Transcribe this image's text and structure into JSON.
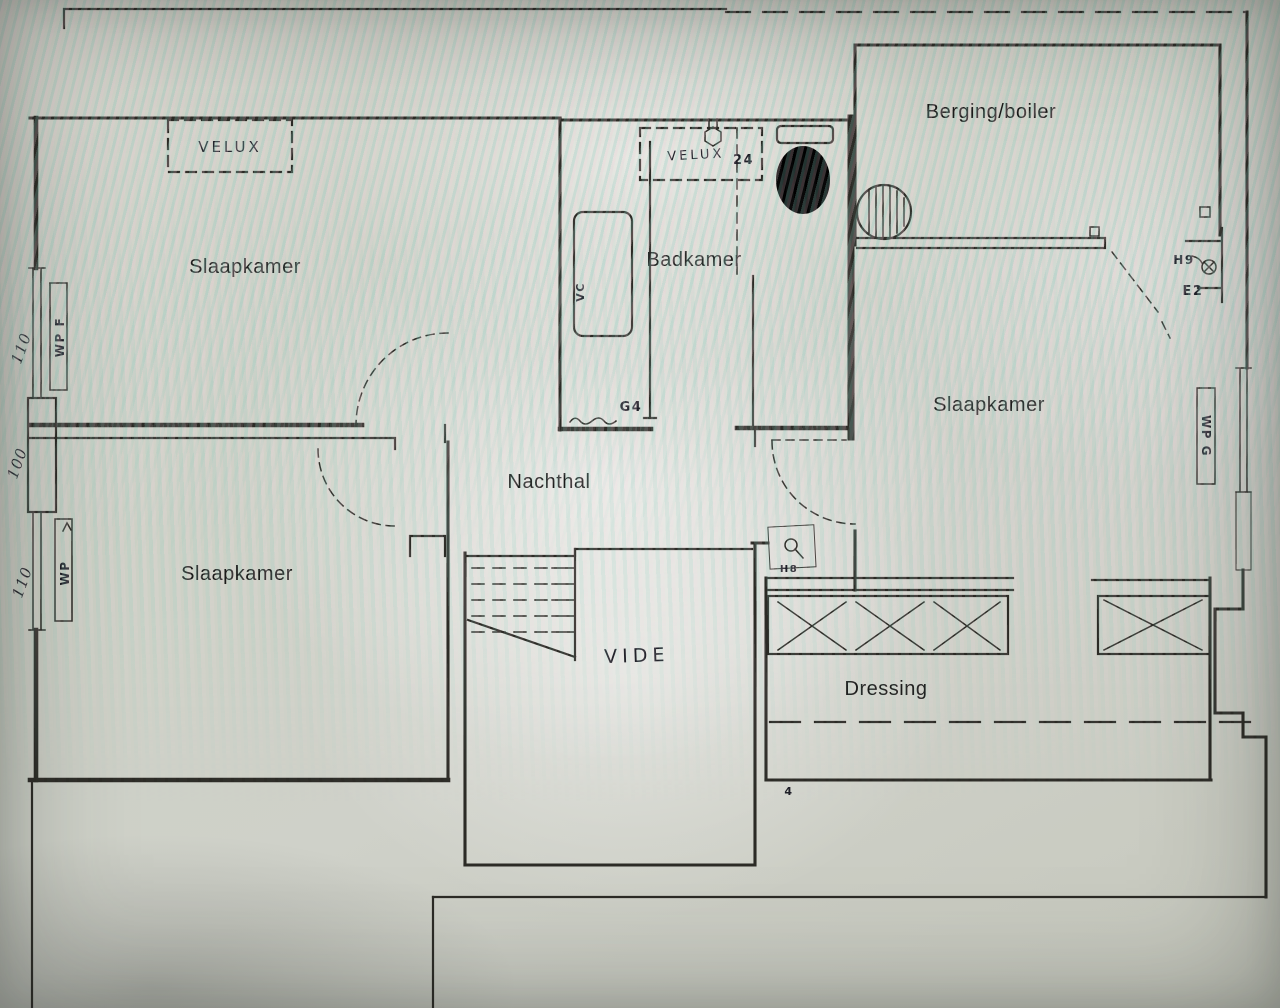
{
  "colors": {
    "paper": "#ccd1c6",
    "ink": "#2c2b26",
    "print_text": "#1b1b1a",
    "moire_teal": "#8fc8c0",
    "moire_pink": "#eccdd8"
  },
  "rooms": {
    "slaapkamer_top_left": "Slaapkamer",
    "slaapkamer_right": "Slaapkamer",
    "slaapkamer_bottom_left": "Slaapkamer",
    "badkamer": "Badkamer",
    "berging": "Berging/boiler",
    "nachthal": "Nachthal",
    "dressing": "Dressing",
    "vide": "VIDE"
  },
  "annotations": {
    "velux_top_left": "VELUX",
    "velux_badkamer": "VELUX",
    "velux_badkamer_number": "24",
    "dim_left_top": "110",
    "dim_left_middle": "100",
    "dim_left_bottom": "110",
    "window_left_top": "WP F",
    "window_left_bottom": "WP",
    "window_right": "WP G",
    "fixture_h9": "H9",
    "fixture_e2": "E2",
    "fixture_h8": "H8",
    "fixture_g4": "G4",
    "duct_vc": "VC",
    "mark_bottom": "4"
  }
}
